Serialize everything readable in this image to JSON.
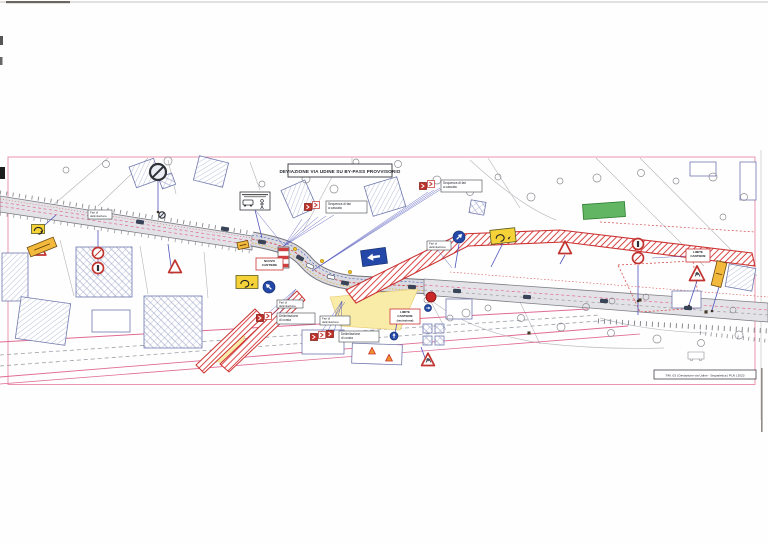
{
  "title": "DEVIAZIONE VIA UDINE SU BY-PASS PROVVISORIO",
  "footer": {
    "text": "TAV. 03 | Deviazione via Udine - Segnaletica | PLN | 2023"
  },
  "sign_labels": {
    "cascade": [
      "Sequenza di fari",
      "a cascata"
    ],
    "delim": [
      "Delimitazione",
      "di corsia"
    ],
    "fari": [
      "Fari di",
      "delimitazione"
    ]
  },
  "red_boxes": [
    {
      "x": 256,
      "y": 258,
      "w": 27,
      "h": 12,
      "lines": [
        "NUOVO",
        "CANTIERE"
      ]
    },
    {
      "x": 390,
      "y": 309,
      "w": 30,
      "h": 15,
      "lines": [
        "LIMITE",
        "CANTIERE",
        "(recinzione)"
      ]
    },
    {
      "x": 686,
      "y": 249,
      "w": 24,
      "h": 13,
      "lines": [
        "LIMITE",
        "CANTIERE"
      ]
    }
  ],
  "white_labels": [
    {
      "x": 88,
      "y": 210,
      "w": 24,
      "h": 9
    },
    {
      "x": 427,
      "y": 241,
      "w": 24,
      "h": 9
    },
    {
      "x": 320,
      "y": 316,
      "w": 30,
      "h": 9
    },
    {
      "x": 277,
      "y": 300,
      "w": 26,
      "h": 8
    }
  ],
  "clusters": [
    {
      "icons": [
        [
          308,
          207
        ],
        [
          316,
          205
        ]
      ],
      "label": {
        "x": 326,
        "y": 201,
        "w": 41,
        "h": 12
      },
      "text": "cascade"
    },
    {
      "icons": [
        [
          423,
          186
        ],
        [
          431,
          184
        ]
      ],
      "label": {
        "x": 441,
        "y": 180,
        "w": 41,
        "h": 12
      },
      "text": "cascade"
    },
    {
      "icons": [
        [
          260,
          318
        ],
        [
          268,
          316
        ]
      ],
      "label": {
        "x": 277,
        "y": 313,
        "w": 38,
        "h": 11
      },
      "text": "delim"
    },
    {
      "icons": [
        [
          314,
          337
        ],
        [
          322,
          335
        ],
        [
          330,
          334
        ]
      ],
      "label": {
        "x": 339,
        "y": 331,
        "w": 40,
        "h": 11
      },
      "text": "delim"
    }
  ],
  "signs": {
    "no_stop_big": [
      {
        "x": 158,
        "y": 172,
        "r": 8
      },
      {
        "x": 162,
        "y": 215,
        "r": 3.2
      }
    ],
    "prohib": [
      {
        "x": 98,
        "y": 253,
        "g": "slash"
      },
      {
        "x": 98,
        "y": 268,
        "g": "bar"
      },
      {
        "x": 638,
        "y": 244,
        "g": "bar"
      },
      {
        "x": 638,
        "y": 258,
        "g": "slash"
      }
    ],
    "triangles": [
      {
        "x": 40,
        "y": 250,
        "s": 10
      },
      {
        "x": 175,
        "y": 267,
        "s": 11
      },
      {
        "x": 565,
        "y": 248,
        "s": 11
      },
      {
        "x": 697,
        "y": 274,
        "s": 13,
        "worker": true
      },
      {
        "x": 428,
        "y": 360,
        "s": 11,
        "worker": true
      },
      {
        "x": 372,
        "y": 351,
        "s": 6,
        "cone": true
      },
      {
        "x": 389,
        "y": 358,
        "s": 6,
        "cone": true
      }
    ],
    "blue_circles": [
      {
        "x": 269,
        "y": 287,
        "r": 6,
        "a": -45
      },
      {
        "x": 459,
        "y": 237,
        "r": 6,
        "a": 45
      },
      {
        "x": 394,
        "y": 336,
        "r": 4,
        "a": 0
      },
      {
        "x": 428,
        "y": 308,
        "r": 3.5,
        "a": 90
      }
    ],
    "red_ball": [
      {
        "x": 431,
        "y": 297,
        "r": 5
      }
    ],
    "blue_rect": [
      {
        "x": 374,
        "y": 257,
        "w": 25,
        "h": 16,
        "rot": -8
      }
    ],
    "yellow_glyph": [
      {
        "x": 247,
        "y": 282,
        "w": 22,
        "h": 13,
        "rot": 0
      },
      {
        "x": 503,
        "y": 236,
        "w": 25,
        "h": 14,
        "rot": -6
      },
      {
        "x": 38,
        "y": 229,
        "w": 13,
        "h": 9,
        "rot": 0
      }
    ],
    "yellow_plain": [
      {
        "x": 42,
        "y": 247,
        "w": 28,
        "h": 10,
        "rot": -22
      },
      {
        "x": 719,
        "y": 274,
        "w": 10,
        "h": 25,
        "rot": 14
      },
      {
        "x": 243,
        "y": 245,
        "w": 11,
        "h": 7,
        "rot": -12
      }
    ],
    "bus_sign": {
      "x": 240,
      "y": 192,
      "w": 30,
      "h": 18
    },
    "barrier": {
      "x": 278,
      "y": 247,
      "w": 11,
      "h": 21
    }
  },
  "cars": [
    [
      225,
      229,
      9,
      false
    ],
    [
      262,
      242,
      9,
      false
    ],
    [
      300,
      258,
      28,
      false
    ],
    [
      345,
      283,
      10,
      false
    ],
    [
      412,
      287,
      4,
      false
    ],
    [
      457,
      291,
      4,
      false
    ],
    [
      527,
      297,
      4,
      false
    ],
    [
      604,
      301,
      4,
      false
    ],
    [
      688,
      308,
      4,
      false
    ],
    [
      140,
      222,
      9,
      false
    ],
    [
      310,
      266,
      25,
      true
    ],
    [
      331,
      277,
      12,
      true
    ]
  ],
  "mini_marks": [
    [
      107,
      216
    ],
    [
      640,
      300
    ],
    [
      706,
      312
    ],
    [
      529,
      333
    ]
  ],
  "lamps": [
    [
      295,
      249
    ],
    [
      322,
      261
    ],
    [
      350,
      272
    ]
  ],
  "trees": [
    [
      168,
      161,
      4
    ],
    [
      106,
      164,
      3.5
    ],
    [
      66,
      170,
      3
    ],
    [
      306,
      179,
      4
    ],
    [
      334,
      189,
      4
    ],
    [
      262,
      184,
      3
    ],
    [
      437,
      180,
      4
    ],
    [
      470,
      192,
      3.5
    ],
    [
      498,
      177,
      3
    ],
    [
      531,
      197,
      4
    ],
    [
      560,
      181,
      3
    ],
    [
      597,
      178,
      4
    ],
    [
      641,
      173,
      3.5
    ],
    [
      676,
      181,
      3
    ],
    [
      713,
      177,
      4
    ],
    [
      744,
      197,
      3.5
    ],
    [
      723,
      217,
      3
    ],
    [
      466,
      313,
      4
    ],
    [
      521,
      318,
      3.5
    ],
    [
      561,
      327,
      4
    ],
    [
      611,
      333,
      3.5
    ],
    [
      657,
      339,
      4
    ],
    [
      701,
      343,
      3.5
    ],
    [
      739,
      335,
      4
    ],
    [
      612,
      301,
      3
    ],
    [
      646,
      297,
      3
    ],
    [
      586,
      307,
      3.5
    ],
    [
      356,
      162,
      3
    ],
    [
      398,
      164,
      3.5
    ],
    [
      427,
      300,
      3
    ],
    [
      450,
      318,
      3
    ],
    [
      488,
      308,
      3
    ],
    [
      733,
      310,
      3
    ]
  ],
  "buildings": [
    {
      "x": 132,
      "y": 162,
      "w": 26,
      "h": 22,
      "rot": -20,
      "fill": "hatch"
    },
    {
      "x": 160,
      "y": 175,
      "w": 14,
      "h": 12,
      "rot": -20,
      "fill": "cross"
    },
    {
      "x": 196,
      "y": 159,
      "w": 30,
      "h": 25,
      "rot": 14,
      "fill": "hatch"
    },
    {
      "x": 2,
      "y": 253,
      "w": 26,
      "h": 48,
      "rot": 0,
      "fill": "hatch"
    },
    {
      "x": 76,
      "y": 247,
      "w": 56,
      "h": 50,
      "rot": 0,
      "fill": "cross"
    },
    {
      "x": 144,
      "y": 296,
      "w": 58,
      "h": 52,
      "rot": 0,
      "fill": "cross"
    },
    {
      "x": 18,
      "y": 300,
      "w": 50,
      "h": 42,
      "rot": 8,
      "fill": "hatch"
    },
    {
      "x": 92,
      "y": 310,
      "w": 38,
      "h": 22,
      "rot": 0,
      "fill": "none"
    },
    {
      "x": 286,
      "y": 184,
      "w": 26,
      "h": 30,
      "rot": -24,
      "fill": "hatch"
    },
    {
      "x": 368,
      "y": 181,
      "w": 34,
      "h": 31,
      "rot": -17,
      "fill": "hatch"
    },
    {
      "x": 470,
      "y": 201,
      "w": 15,
      "h": 13,
      "rot": 10,
      "fill": "cross"
    },
    {
      "x": 302,
      "y": 330,
      "w": 42,
      "h": 24,
      "rot": 0,
      "fill": "none"
    },
    {
      "x": 352,
      "y": 344,
      "w": 50,
      "h": 20,
      "rot": 2,
      "fill": "none"
    },
    {
      "x": 423,
      "y": 324,
      "w": 9,
      "h": 9,
      "rot": 0,
      "fill": "cross"
    },
    {
      "x": 435,
      "y": 324,
      "w": 9,
      "h": 9,
      "rot": 0,
      "fill": "cross"
    },
    {
      "x": 423,
      "y": 336,
      "w": 9,
      "h": 9,
      "rot": 0,
      "fill": "cross"
    },
    {
      "x": 435,
      "y": 336,
      "w": 9,
      "h": 9,
      "rot": 0,
      "fill": "cross"
    },
    {
      "x": 446,
      "y": 299,
      "w": 26,
      "h": 20,
      "rot": 0,
      "fill": "none"
    },
    {
      "x": 583,
      "y": 203,
      "w": 42,
      "h": 15,
      "rot": -4,
      "fill": "green"
    },
    {
      "x": 727,
      "y": 266,
      "w": 27,
      "h": 23,
      "rot": 10,
      "fill": "hatch"
    },
    {
      "x": 672,
      "y": 291,
      "w": 29,
      "h": 17,
      "rot": 0,
      "fill": "none"
    },
    {
      "x": 740,
      "y": 162,
      "w": 16,
      "h": 38,
      "rot": 0,
      "fill": "none"
    },
    {
      "x": 690,
      "y": 162,
      "w": 26,
      "h": 14,
      "rot": 0,
      "fill": "none"
    }
  ],
  "fans": [
    {
      "pts": [
        [
          256,
          211
        ],
        [
          302,
          219
        ],
        [
          310,
          218
        ],
        [
          318,
          217
        ],
        [
          326,
          216
        ],
        [
          334,
          215
        ]
      ],
      "to": [
        284,
        246
      ]
    },
    {
      "pts": [
        [
          428,
          192
        ],
        [
          434,
          190
        ],
        [
          440,
          188
        ],
        [
          446,
          186
        ]
      ],
      "to": [
        312,
        271
      ]
    },
    {
      "pts": [
        [
          265,
          316
        ],
        [
          272,
          315
        ],
        [
          279,
          314
        ]
      ],
      "to": [
        296,
        289
      ]
    },
    {
      "pts": [
        [
          320,
          334
        ],
        [
          327,
          333
        ],
        [
          334,
          332
        ],
        [
          341,
          331
        ]
      ],
      "to": [
        342,
        301
      ]
    },
    {
      "pts": [
        [
          686,
          256
        ]
      ],
      "to": [
        652,
        258
      ]
    },
    {
      "pts": [
        [
          437,
          249
        ]
      ],
      "to": [
        452,
        268
      ]
    },
    {
      "pts": [
        [
          335,
          316
        ]
      ],
      "to": [
        345,
        302
      ]
    }
  ],
  "poles": [
    [
      158,
      181,
      158,
      212
    ],
    [
      98,
      276,
      98,
      230
    ],
    [
      172,
      274,
      168,
      244
    ],
    [
      36,
      233,
      56,
      215
    ],
    [
      638,
      265,
      638,
      300
    ],
    [
      697,
      281,
      689,
      305
    ],
    [
      719,
      287,
      712,
      310
    ],
    [
      565,
      255,
      560,
      264
    ],
    [
      431,
      302,
      432,
      291
    ],
    [
      394,
      340,
      397,
      322
    ],
    [
      428,
      366,
      421,
      347
    ],
    [
      255,
      210,
      262,
      238
    ],
    [
      503,
      243,
      491,
      267
    ],
    [
      459,
      244,
      455,
      268
    ],
    [
      638,
      300,
      638,
      315
    ]
  ],
  "parcel_lines": [
    [
      60,
      240,
      74,
      296
    ],
    [
      140,
      246,
      148,
      294
    ],
    [
      204,
      252,
      208,
      298
    ],
    [
      168,
      160,
      176,
      194
    ],
    [
      250,
      162,
      260,
      190
    ],
    [
      108,
      158,
      52,
      206
    ],
    [
      148,
      158,
      98,
      206
    ],
    [
      640,
      158,
      757,
      276
    ],
    [
      596,
      158,
      704,
      266
    ],
    [
      488,
      158,
      520,
      208
    ],
    [
      332,
      177,
      303,
      231
    ],
    [
      430,
      300,
      446,
      330
    ],
    [
      520,
      302,
      540,
      344
    ],
    [
      352,
      157,
      352,
      164
    ]
  ],
  "colors": {
    "frame_pink": "#e995ad",
    "hatch_red": "#d94545",
    "band_edge": "#cc3333",
    "road_fill": "#e3e3e7",
    "road_edge": "#7c7c84",
    "building_outline": "#7079ad",
    "violet": "#5055bb",
    "lane_pink": "#e06a94",
    "sign_yellow": "#f5d338",
    "area_yellow": "#f9eca8",
    "green": "#62b562",
    "sign_red": "#c23430",
    "sign_blue": "#2448a8",
    "dark": "#2e3038"
  }
}
